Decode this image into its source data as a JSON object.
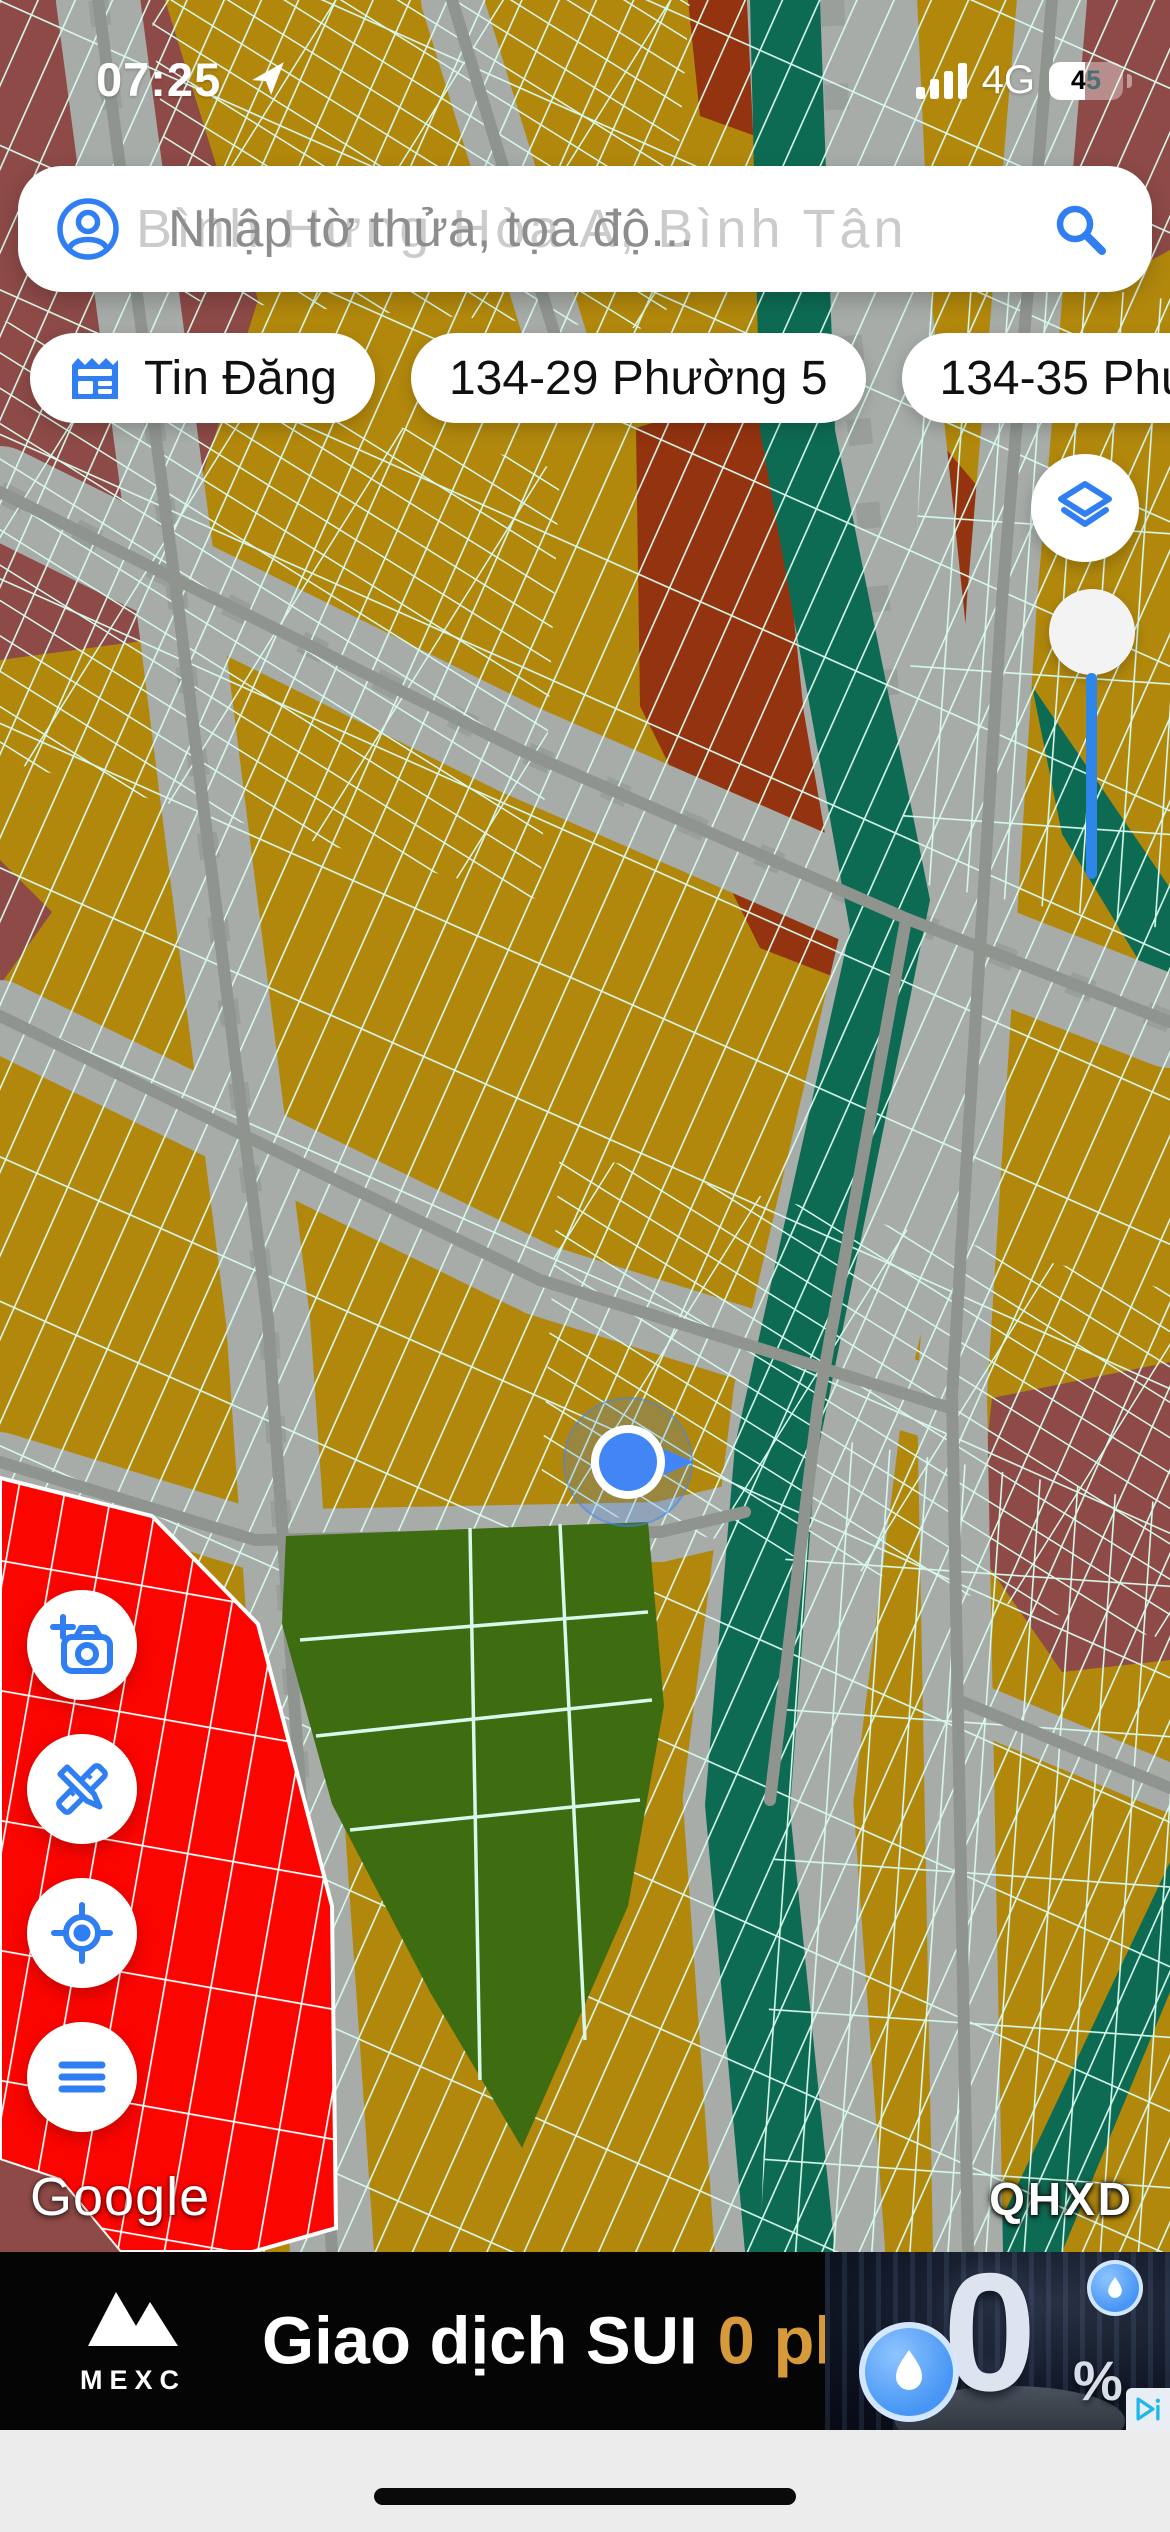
{
  "status_bar": {
    "time": "07:25",
    "network": "4G",
    "battery_percent": "45",
    "icons": [
      "location-arrow-icon",
      "signal-bars-icon",
      "battery-icon"
    ]
  },
  "search": {
    "ghost_text": "Bình Hưng Hòa A, Bình Tân",
    "placeholder": "Nhập tờ thửa, tọa độ...",
    "icons": [
      "account-icon",
      "search-icon"
    ]
  },
  "chips": [
    {
      "label": "Tin Đăng",
      "icon": "newspaper-icon"
    },
    {
      "label": "134-29 Phường 5"
    },
    {
      "label": "134-35 Phường"
    }
  ],
  "map": {
    "google_logo": "Google",
    "layer_badge": "QHXD",
    "location_marker": "blue-heading-dot",
    "zone_colors": {
      "residential_gold": "#b2880c",
      "planning_brick": "#93330f",
      "planning_mauve": "#8d4a47",
      "canal_teal": "#0d6b53",
      "park_olive": "#3e6c10",
      "highlight_red": "#fb0500",
      "parcel_line_mint": "#d7f8ea",
      "road_gray": "#a7aca8"
    }
  },
  "controls": {
    "right": [
      "layers-icon",
      "opacity-slider"
    ],
    "left": [
      "camera-plus-icon",
      "measure-draw-icon",
      "gps-locate-icon",
      "menu-icon"
    ],
    "accent_blue": "#2f7ef2",
    "slider_blue": "#2e86e9"
  },
  "ad": {
    "brand": "MEXC",
    "headline": "Giao dịch SUI",
    "offer": "0 phí",
    "zero": "0",
    "percent": "%",
    "offer_color": "#d79a3b",
    "icons": [
      "mexc-logo",
      "sui-drop-coin",
      "adchoices-icon"
    ]
  }
}
